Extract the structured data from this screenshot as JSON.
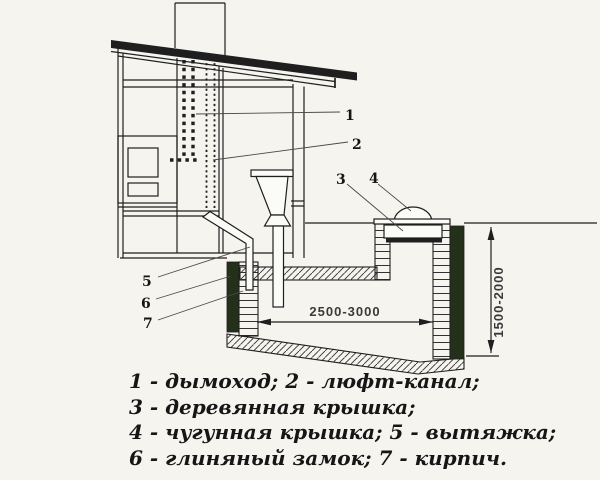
{
  "colors": {
    "background": "#f5f4ef",
    "line": "#1f1f1f",
    "clay": "#243019",
    "leader": "#4a4a4a",
    "dim_text": "#3a3a3a"
  },
  "dimensions": {
    "pit_width": "2500-3000",
    "pit_depth": "1500-2000"
  },
  "callouts": {
    "n1": "1",
    "n2": "2",
    "n3": "3",
    "n4": "4",
    "n5": "5",
    "n6": "6",
    "n7": "7"
  },
  "legend": {
    "line1": "1 - дымоход; 2 - люфт-канал;",
    "line2": "3 - деревянная крышка;",
    "line3": "4 - чугунная крышка; 5 - вытяжка;",
    "line4": "6 - глиняный замок; 7 - кирпич."
  }
}
